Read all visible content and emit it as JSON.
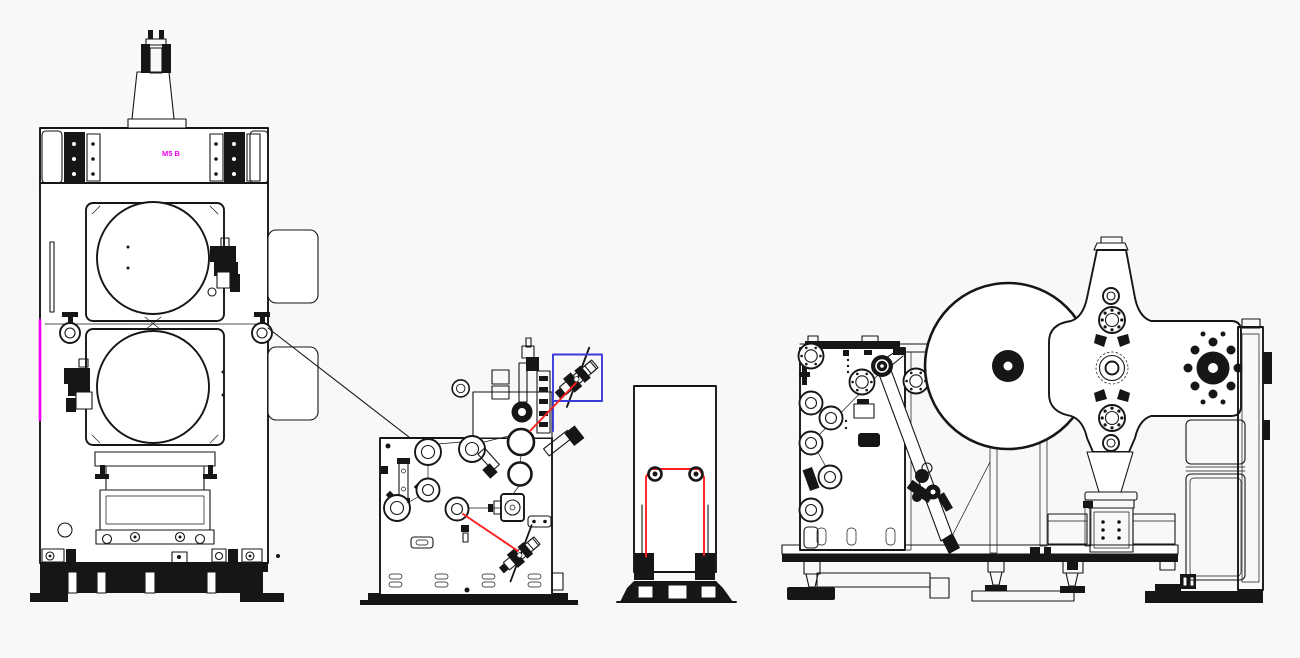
{
  "meta": {
    "width": 1300,
    "height": 658,
    "background": "#f8f8f8",
    "drawing_type": "cad-machine-line-layout"
  },
  "colors": {
    "ink": "#161616",
    "paper": "#ffffff",
    "magenta": "#ee00ee",
    "red": "#ff1f1f",
    "blue": "#3a3ad8"
  },
  "diagram": {
    "components": [
      "roll-press-calender",
      "coating-unit",
      "web-accumulator-stand",
      "turret-winder"
    ],
    "annotations": {
      "machine_label": {
        "text": "M5 B",
        "color": "#ee00ee"
      },
      "edge_marker_color": "#ee00ee",
      "web_path_color": "#ff1f1f",
      "highlight_box_color": "#3a3ad8"
    }
  }
}
